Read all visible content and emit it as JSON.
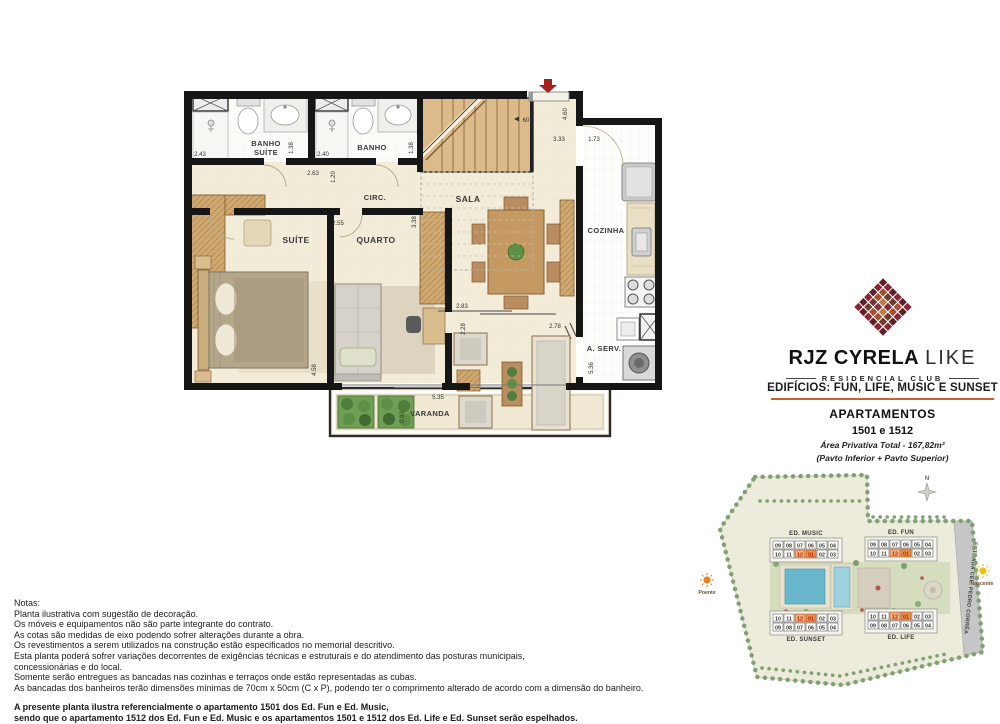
{
  "logo": {
    "brand_bold": "RJZ CYRELA",
    "brand_light": "LIKE",
    "subtitle": "RESIDENCIAL CLUB",
    "mark_palette": [
      "#5f2128",
      "#8c3038",
      "#a74d30",
      "#bf7a41",
      "#8d2436",
      "#6e3a2c"
    ]
  },
  "info": {
    "buildings_line": "EDIFÍCIOS:  FUN, LIFE, MUSIC E SUNSET",
    "underline_color": "#cf5f28",
    "apartments_label": "APARTAMENTOS",
    "apartments_numbers": "1501 e 1512",
    "area_line": "Área Privativa Total - 167,82m²",
    "floors_line": "(Pavto Inferior + Pavto Superior)"
  },
  "plan": {
    "rooms": {
      "banho_suite_l1": "BANHO",
      "banho_suite_l2": "SUÍTE",
      "banho": "BANHO",
      "circ": "CIRC.",
      "sala": "SALA",
      "suite": "SUÍTE",
      "quarto": "QUARTO",
      "cozinha": "COZINHA",
      "a_serv": "A. SERV.",
      "varanda": "VARANDA"
    },
    "dims": {
      "banho_suite_width": "2.43",
      "banho_suite_door": "1.38",
      "banho_width": "2.40",
      "banho_door": "1.38",
      "circ_width": "2.63",
      "circ_depth": "1.20",
      "quarto_width": "2.55",
      "quarto_depth": "3.38",
      "suite_depth": "4.58",
      "entry_depth": "4.60",
      "entry_width": "3.33",
      "cozinha_width": "1.73",
      "stair_width": "60",
      "sala_width": "2.83",
      "terrace_depth": "2.28",
      "terrace_width": "2.78",
      "varanda_width": "5.35",
      "varanda_depth": "0.93",
      "aserv_depth": "5.36"
    }
  },
  "site": {
    "buildings": [
      {
        "name": "ED. MUSIC",
        "label_pos": "top",
        "rows": [
          [
            "09",
            "08",
            "07",
            "06",
            "05",
            "04"
          ],
          [
            "10",
            "11",
            "12",
            "01",
            "02",
            "03"
          ]
        ]
      },
      {
        "name": "ED. FUN",
        "label_pos": "top",
        "rows": [
          [
            "09",
            "08",
            "07",
            "06",
            "05",
            "04"
          ],
          [
            "10",
            "11",
            "12",
            "01",
            "02",
            "03"
          ]
        ]
      },
      {
        "name": "ED. SUNSET",
        "label_pos": "bottom",
        "rows": [
          [
            "10",
            "11",
            "12",
            "01",
            "02",
            "03"
          ],
          [
            "09",
            "08",
            "07",
            "06",
            "05",
            "04"
          ]
        ]
      },
      {
        "name": "ED. LIFE",
        "label_pos": "bottom",
        "rows": [
          [
            "10",
            "11",
            "12",
            "01",
            "02",
            "03"
          ],
          [
            "09",
            "08",
            "07",
            "06",
            "05",
            "04"
          ]
        ]
      }
    ],
    "highlighted_units": [
      "12",
      "01"
    ],
    "highlight_colors": {
      "cell_12": "#f2ae74",
      "cell_01": "#ea8f44",
      "text": "#b51f1f"
    },
    "road_label": "ESTRADA CEL. PEDRO CORRÊA",
    "compass_label": "N",
    "sun_west": "Poente",
    "sun_east": "Nascente"
  },
  "notes": {
    "title": "Notas:",
    "lines": [
      "Planta ilustrativa com sugestão de decoração.",
      "Os móveis e equipamentos não são parte integrante do contrato.",
      "As cotas são  medidas  de  eixo podendo sofrer alterações durante a obra.",
      "Os revestimentos a serem utilizados na construção estão especificados no memorial descritivo.",
      "Esta planta poderá sofrer variações decorrentes de exigências técnicas e estruturais e do atendimento das posturas municipais,",
      "concessionárias e do local.",
      "Somente serão entregues as bancadas nas cozinhas e terraços onde estão representadas as cubas.",
      "As bancadas dos banheiros terão dimensões mínimas de 70cm x 50cm (C x P), podendo ter o comprimento alterado de acordo com a dimensão do banheiro."
    ],
    "bold_lines": [
      "A presente planta ilustra referencialmente o apartamento 1501 dos Ed. Fun e Ed. Music,",
      "sendo que o apartamento 1512 dos Ed. Fun e Ed. Music e os apartamentos 1501 e 1512 dos Ed. Life e Ed. Sunset serão espelhados."
    ]
  }
}
